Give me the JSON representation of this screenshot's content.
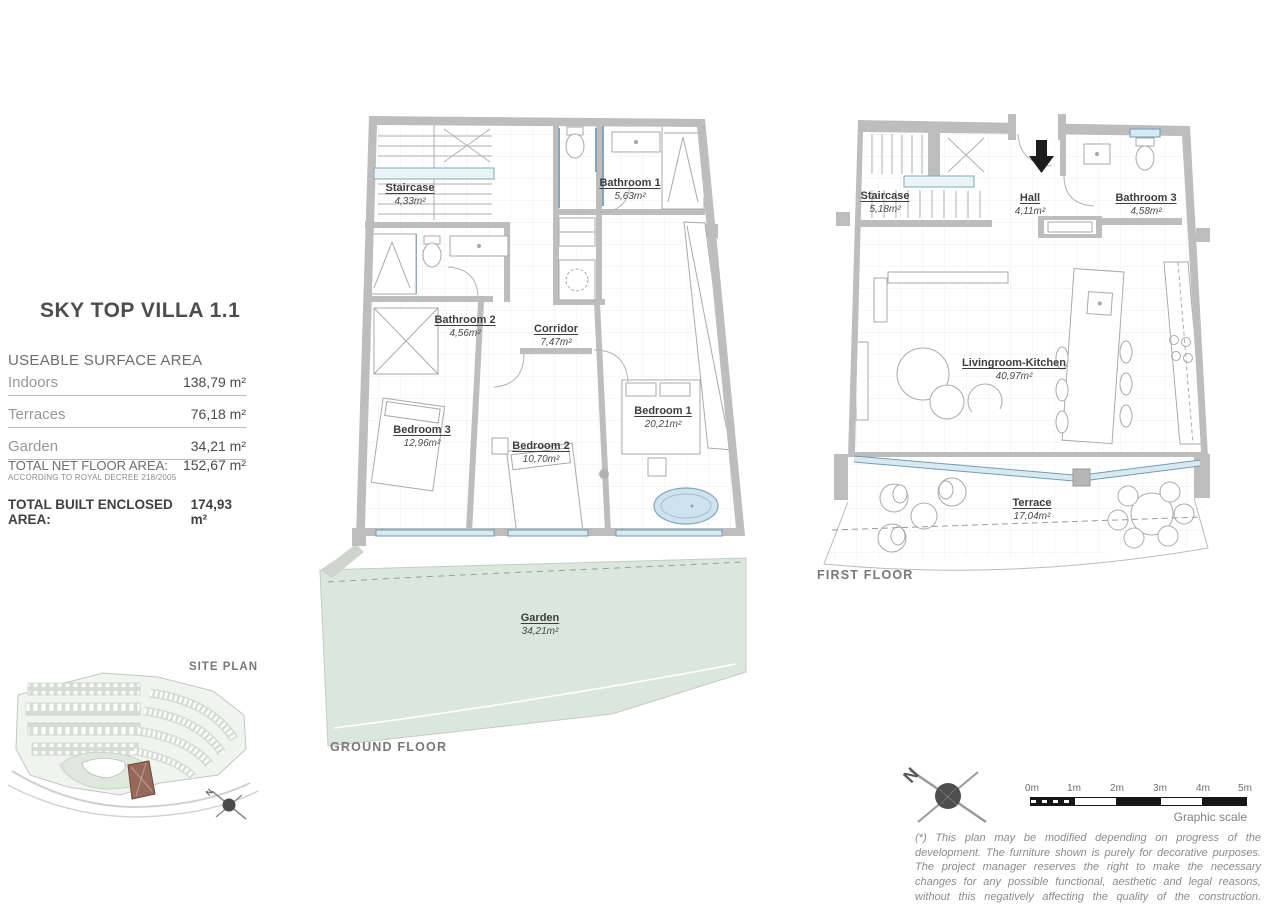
{
  "info_panel": {
    "title": "SKY TOP VILLA 1.1",
    "section_heading": "USEABLE SURFACE AREA",
    "rows": [
      {
        "label": "Indoors",
        "value": "138,79 m²"
      },
      {
        "label": "Terraces",
        "value": "76,18 m²"
      },
      {
        "label": "Garden",
        "value": "34,21 m²"
      }
    ],
    "total_net": {
      "label": "TOTAL NET FLOOR AREA:",
      "value": "152,67  m²",
      "note": "ACCORDING TO ROYAL DECREE 218/2005"
    },
    "total_built": {
      "label": "TOTAL BUILT ENCLOSED AREA:",
      "value": "174,93 m²"
    }
  },
  "ground_floor": {
    "caption": "GROUND FLOOR",
    "rooms": [
      {
        "name": "Staircase",
        "area": "4,33m²"
      },
      {
        "name": "Bathroom 1",
        "area": "5,63m²"
      },
      {
        "name": "Bathroom 2",
        "area": "4,56m²"
      },
      {
        "name": "Corridor",
        "area": "7,47m²"
      },
      {
        "name": "Bedroom 3",
        "area": "12,96m²"
      },
      {
        "name": "Bedroom 2",
        "area": "10,70m²"
      },
      {
        "name": "Bedroom 1",
        "area": "20,21m²"
      },
      {
        "name": "Garden",
        "area": "34,21m²"
      }
    ]
  },
  "first_floor": {
    "caption": "FIRST FLOOR",
    "rooms": [
      {
        "name": "Staircase",
        "area": "5,18m²"
      },
      {
        "name": "Hall",
        "area": "4,11m²"
      },
      {
        "name": "Bathroom 3",
        "area": "4,58m²"
      },
      {
        "name": "Livingroom-Kitchen",
        "area": "40,97m²"
      },
      {
        "name": "Terrace",
        "area": "17,04m²"
      }
    ]
  },
  "site_plan": {
    "caption": "SITE PLAN"
  },
  "north_arrow": {
    "label": "N"
  },
  "scale_bar": {
    "ticks": [
      "0m",
      "1m",
      "2m",
      "3m",
      "4m",
      "5m"
    ],
    "caption": "Graphic scale"
  },
  "disclaimer": "(*) This plan may be modified depending on progress of the development. The furniture shown is purely for decorative purposes. The project manager reserves the right to make the necessary changes for any possible functional, aesthetic and legal reasons, without this negatively affecting the quality of the construction. Illustrative dimensions.",
  "colors": {
    "wall": "#bcbdbc",
    "window_fill": "#d7e9f1",
    "window_stroke": "#6f9cb0",
    "garden": "#dbe6dc",
    "site_green": "#dfe8dc",
    "plot_brown": "#96695a",
    "text_dark": "#3d3e40",
    "text_gray": "#808285"
  }
}
